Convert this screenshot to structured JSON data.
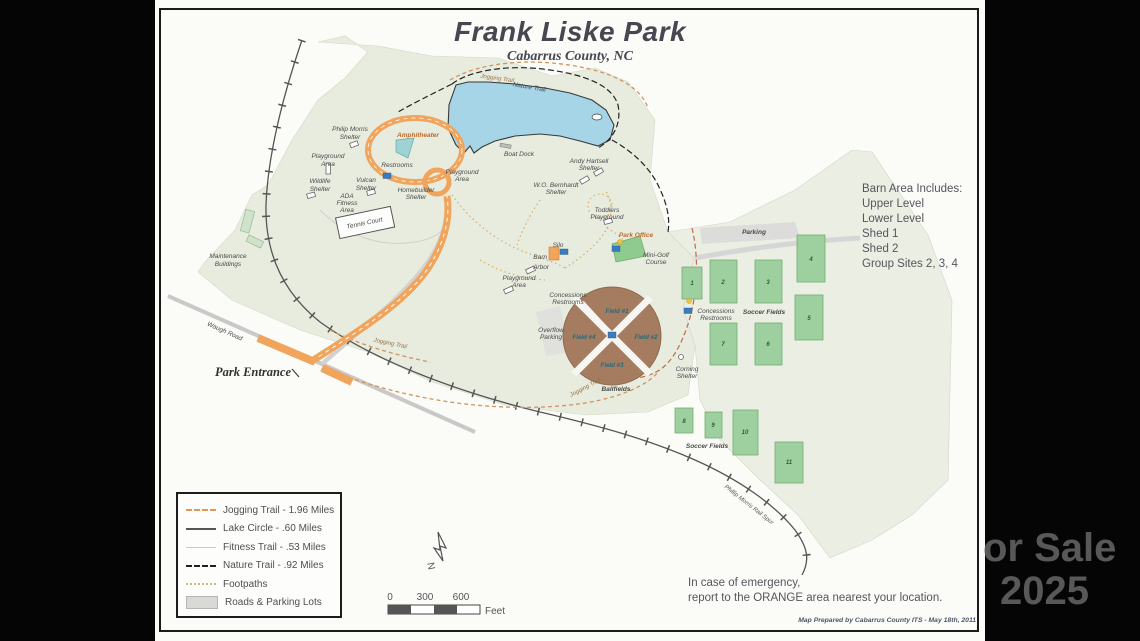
{
  "title": {
    "main": "Frank Liske Park",
    "subtitle": "Cabarrus County, NC"
  },
  "barn_area": {
    "heading": "Barn Area Includes:",
    "lines": [
      "Upper Level",
      "Lower Level",
      "Shed 1",
      "Shed 2",
      "Group Sites 2, 3, 4"
    ]
  },
  "legend": {
    "items": [
      {
        "label": "Jogging Trail - 1.96 Miles",
        "swatch": "jogging-trail-line"
      },
      {
        "label": "Lake Circle - .60 Miles",
        "swatch": "lake-circle-line"
      },
      {
        "label": "Fitness Trail - .53 Miles",
        "swatch": "fitness-trail-line"
      },
      {
        "label": "Nature Trail - .92 Miles",
        "swatch": "nature-trail-line"
      },
      {
        "label": "Footpaths",
        "swatch": "footpath-line"
      },
      {
        "label": "Roads & Parking Lots",
        "swatch": "road-parking-fill"
      }
    ]
  },
  "scale": {
    "tick0": "0",
    "tick1": "300",
    "tick2": "600",
    "unit": "Feet"
  },
  "north": {
    "label": "N"
  },
  "emergency": {
    "line1": "In case of emergency,",
    "line2": "report to the ORANGE area nearest your location."
  },
  "credit": "Map Prepared by Cabarrus County ITS - May 18th, 2011",
  "watermark": {
    "line1": "or Sale",
    "line2": "2025"
  },
  "map": {
    "labels": [
      "Philip Morris",
      "Shelter",
      "Playground",
      "Area",
      "Wildlife",
      "Shelter",
      "Vulcan",
      "Shelter",
      "ADA",
      "Fitness",
      "Area",
      "Tennis Court",
      "Maintenance",
      "Buildings",
      "Amphitheater",
      "Restrooms",
      "Homebuilder",
      "Shelter",
      "Playground",
      "Area",
      "Jogging Trail",
      "Nature Trail",
      "Boat Dock",
      "Andy Hartsell",
      "Shelter",
      "W.O. Bernhardt",
      "Shelter",
      "Toddlers",
      "Playground",
      "Park Office",
      "Mini-Golf",
      "Course",
      "Silo",
      "Barn",
      "Arbor",
      "Playground",
      "Area",
      "Concessions",
      "Restrooms",
      "Overflow",
      "Parking",
      "Ballfields",
      "Parking",
      "Concessions",
      "Restrooms",
      "Soccer Fields",
      "Corning",
      "Shelter",
      "Soccer Fields",
      "Waugh Road",
      "Park Entrance",
      "Phillip Morris Rail Spur",
      "Jogging Trail",
      "Jogging Trail"
    ],
    "ballfields": [
      "Field #1",
      "Field #2",
      "Field #3",
      "Field #4"
    ],
    "soccer_numbers": [
      "1",
      "2",
      "3",
      "4",
      "5",
      "6",
      "7",
      "8",
      "9",
      "10",
      "11"
    ],
    "colors": {
      "emergency_orange": "#f0a45c",
      "lake_blue": "#a6d5e8",
      "field_green": "#9ecf9e",
      "ballfield_brown": "#a57c5f",
      "park_fill": "#e7ecdf"
    }
  }
}
